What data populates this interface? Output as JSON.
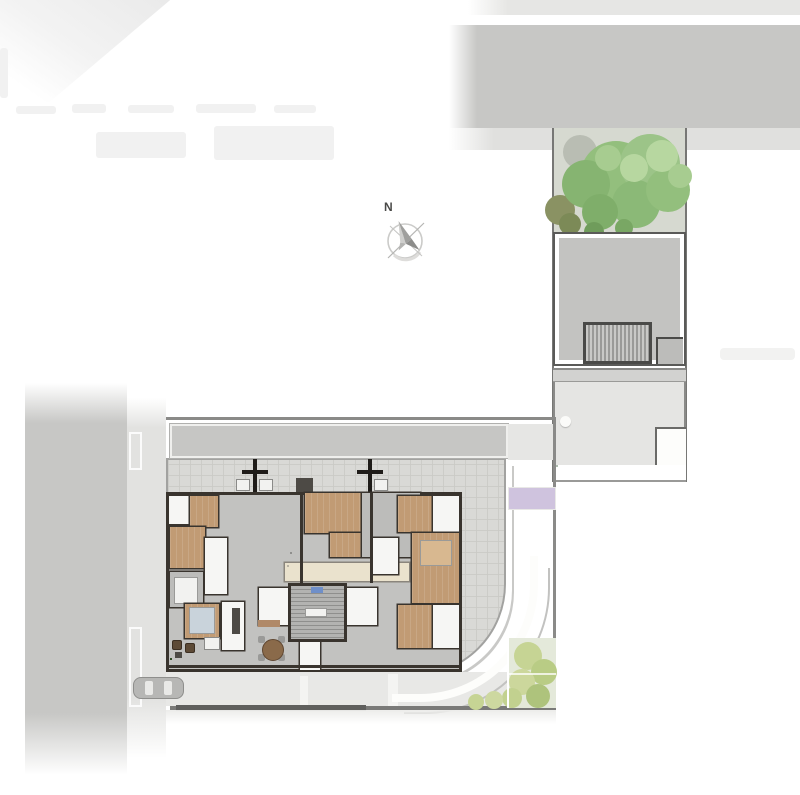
{
  "title": "Residential implantation ground-floor plan",
  "compass": {
    "label": "N"
  },
  "palette": {
    "street": "#c7c7c5",
    "sidewalk": "#e2e2e0",
    "terrace": "#d9d9d6",
    "parking_stripe": "#ddd6a0",
    "boundary": "#7a7a78",
    "wall": "#39342e",
    "wood": "#c19b74",
    "living": "#bcbcba",
    "counter": "#eae2cd",
    "planter_green": "#49703c",
    "lawn_green_1": "#c8dcb2",
    "lawn_green_2": "#bad2a2",
    "lawn_green_3": "#d9e4d6",
    "lawn_purple_1": "#cfc3de",
    "lawn_purple_2": "#d8cfe4",
    "bush_yellow": "#c6d494",
    "tree_green": "#93bf7d",
    "tree_green_light": "#b7d7a0",
    "tree_green_dark": "#6f9c5b",
    "bush_olive": "#8a9263",
    "car_body": "#b7b7b5",
    "blue_accent": "#6f8fc9",
    "table_wood": "#8a6a4a"
  },
  "parking": {
    "stripe_count": 7
  },
  "courtyard": {
    "planter_count": 6
  },
  "lounge": {
    "planter_count": 3
  },
  "garden": {
    "rows": [
      "lawn_green_1",
      "lawn_green_2",
      "lawn_green_1",
      "lawn_green_2",
      "lawn_purple_1",
      "lawn_purple_2",
      "lawn_purple_1"
    ]
  }
}
